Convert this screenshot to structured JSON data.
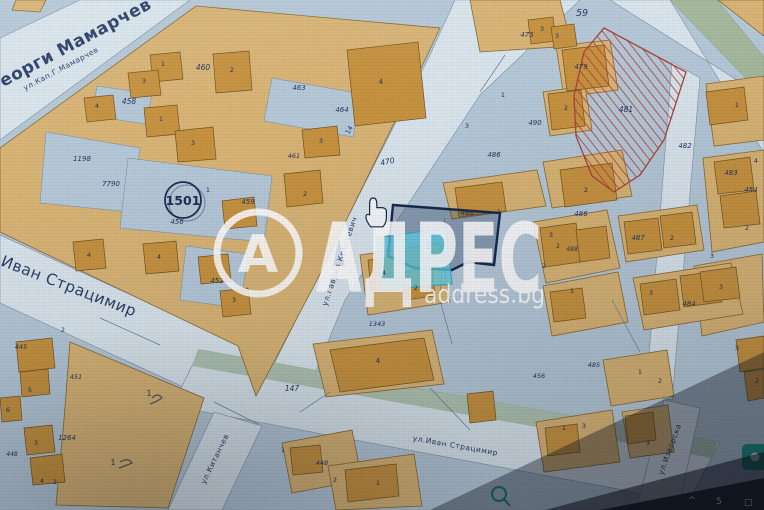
{
  "watermark": {
    "brand": "АДРЕС",
    "domain": "address.bg",
    "logo_letter": "А"
  },
  "taskbar": {
    "glyphs": [
      "^",
      "5",
      "□"
    ]
  },
  "map": {
    "type": "cadastral-map",
    "quarter_badge": "1501",
    "highlighted_parcel_number": "2",
    "street_labels": [
      {
        "name": "Георги Мамарчев",
        "x": 73,
        "y": 50,
        "s": 17,
        "r": -28,
        "w": 700,
        "ls": 1
      },
      {
        "name": "ул.Кап.Г.Мамарчев",
        "x": 62,
        "y": 71,
        "s": 7.5,
        "r": -28,
        "w": 400
      },
      {
        "name": "Иван Страцимир",
        "x": 67,
        "y": 291,
        "s": 15.5,
        "r": 21,
        "w": 500,
        "ls": 1
      },
      {
        "name": "ул.Гаврил Кръстевич",
        "x": 342,
        "y": 262,
        "s": 7.5,
        "r": -71,
        "w": 400
      },
      {
        "name": "ул.Иван Страцимир",
        "x": 455,
        "y": 448,
        "s": 7.5,
        "r": 10,
        "w": 400
      },
      {
        "name": "ул.Китанчев",
        "x": 217,
        "y": 460,
        "s": 7.5,
        "r": -64,
        "w": 400
      },
      {
        "name": "ул.Изворска",
        "x": 672,
        "y": 450,
        "s": 7.5,
        "r": -70,
        "w": 400
      }
    ],
    "parcel_labels": [
      {
        "t": "458",
        "x": 129,
        "y": 104,
        "s": 7.5,
        "it": 1
      },
      {
        "t": "460",
        "x": 203,
        "y": 70,
        "s": 7.5,
        "it": 1
      },
      {
        "t": "1",
        "x": 163,
        "y": 66,
        "s": 6.5
      },
      {
        "t": "3",
        "x": 144,
        "y": 83,
        "s": 6.5
      },
      {
        "t": "4",
        "x": 97,
        "y": 108,
        "s": 6.5
      },
      {
        "t": "2",
        "x": 232,
        "y": 72,
        "s": 6.5
      },
      {
        "t": "1",
        "x": 161,
        "y": 121,
        "s": 6.5
      },
      {
        "t": "3",
        "x": 193,
        "y": 145,
        "s": 6.5
      },
      {
        "t": "1198",
        "x": 82,
        "y": 161,
        "s": 7,
        "it": 1
      },
      {
        "t": "7790",
        "x": 111,
        "y": 186,
        "s": 7,
        "it": 1
      },
      {
        "t": "456",
        "x": 177,
        "y": 224,
        "s": 7,
        "it": 1
      },
      {
        "t": "459",
        "x": 248,
        "y": 204,
        "s": 7,
        "it": 1
      },
      {
        "t": "1",
        "x": 208,
        "y": 192,
        "s": 6.5
      },
      {
        "t": "452",
        "x": 217,
        "y": 283,
        "s": 7,
        "it": 1
      },
      {
        "t": "3",
        "x": 234,
        "y": 302,
        "s": 6.5
      },
      {
        "t": "4",
        "x": 89,
        "y": 257,
        "s": 6.5
      },
      {
        "t": "4",
        "x": 159,
        "y": 259,
        "s": 6.5
      },
      {
        "t": "2",
        "x": 305,
        "y": 196,
        "s": 6.5
      },
      {
        "t": "2",
        "x": 63,
        "y": 332,
        "s": 6.5
      },
      {
        "t": "463",
        "x": 299,
        "y": 90,
        "s": 7,
        "it": 1
      },
      {
        "t": "464",
        "x": 342,
        "y": 112,
        "s": 7,
        "it": 1
      },
      {
        "t": "4",
        "x": 381,
        "y": 84,
        "s": 7
      },
      {
        "t": "3",
        "x": 321,
        "y": 143,
        "s": 6.5
      },
      {
        "t": "461",
        "x": 294,
        "y": 158,
        "s": 6.5,
        "it": 1
      },
      {
        "t": "14",
        "x": 351,
        "y": 131,
        "s": 6.5,
        "r": -60
      },
      {
        "t": "470",
        "x": 388,
        "y": 164,
        "s": 7.5,
        "r": -12,
        "it": 1
      },
      {
        "t": "3",
        "x": 467,
        "y": 128,
        "s": 6.5
      },
      {
        "t": "1",
        "x": 503,
        "y": 97,
        "s": 6.5
      },
      {
        "t": "490",
        "x": 535,
        "y": 125,
        "s": 7,
        "it": 1
      },
      {
        "t": "486",
        "x": 494,
        "y": 157,
        "s": 7,
        "it": 1
      },
      {
        "t": "59",
        "x": 582,
        "y": 16,
        "s": 9.5,
        "it": 1
      },
      {
        "t": "475",
        "x": 527,
        "y": 37,
        "s": 7,
        "it": 1
      },
      {
        "t": "3",
        "x": 542,
        "y": 31,
        "s": 6.5
      },
      {
        "t": "3",
        "x": 557,
        "y": 38,
        "s": 6.5
      },
      {
        "t": "479",
        "x": 581,
        "y": 69,
        "s": 7,
        "it": 1
      },
      {
        "t": "2",
        "x": 566,
        "y": 110,
        "s": 6.5
      },
      {
        "t": "481",
        "x": 626,
        "y": 112,
        "s": 7.5,
        "it": 1
      },
      {
        "t": "1",
        "x": 737,
        "y": 107,
        "s": 6.5
      },
      {
        "t": "483",
        "x": 731,
        "y": 175,
        "s": 7,
        "it": 1
      },
      {
        "t": "454",
        "x": 751,
        "y": 192,
        "s": 7,
        "it": 1
      },
      {
        "t": "2",
        "x": 747,
        "y": 230,
        "s": 6.5
      },
      {
        "t": "482",
        "x": 685,
        "y": 148,
        "s": 7,
        "it": 1
      },
      {
        "t": "4",
        "x": 756,
        "y": 163,
        "s": 6.5
      },
      {
        "t": "3",
        "x": 721,
        "y": 289,
        "s": 6.5
      },
      {
        "t": "2",
        "x": 586,
        "y": 192,
        "s": 6.5
      },
      {
        "t": "486",
        "x": 581,
        "y": 216,
        "s": 7,
        "it": 1
      },
      {
        "t": "3",
        "x": 551,
        "y": 237,
        "s": 6.5
      },
      {
        "t": "2",
        "x": 558,
        "y": 248,
        "s": 6
      },
      {
        "t": "488",
        "x": 572,
        "y": 251,
        "s": 6,
        "it": 1
      },
      {
        "t": "2",
        "x": 544,
        "y": 268,
        "s": 6.5
      },
      {
        "t": "487",
        "x": 638,
        "y": 240,
        "s": 7,
        "it": 1
      },
      {
        "t": "2",
        "x": 672,
        "y": 240,
        "s": 6.5
      },
      {
        "t": "3",
        "x": 712,
        "y": 258,
        "s": 6.5
      },
      {
        "t": "1",
        "x": 572,
        "y": 293,
        "s": 6.5
      },
      {
        "t": "3",
        "x": 651,
        "y": 295,
        "s": 6.5
      },
      {
        "t": "484",
        "x": 689,
        "y": 306,
        "s": 7,
        "it": 1
      },
      {
        "t": "488",
        "x": 467,
        "y": 215,
        "s": 7,
        "it": 1
      },
      {
        "t": "1",
        "x": 499,
        "y": 214,
        "s": 6.5
      },
      {
        "t": "4",
        "x": 384,
        "y": 275,
        "s": 6.5
      },
      {
        "t": "2",
        "x": 416,
        "y": 290,
        "s": 6.5
      },
      {
        "t": "1343",
        "x": 377,
        "y": 326,
        "s": 6.5,
        "it": 1
      },
      {
        "t": "4",
        "x": 378,
        "y": 363,
        "s": 7
      },
      {
        "t": "147",
        "x": 292,
        "y": 391,
        "s": 7.5,
        "it": 1
      },
      {
        "t": "1264",
        "x": 67,
        "y": 440,
        "s": 7,
        "it": 1
      },
      {
        "t": "1",
        "x": 149,
        "y": 396,
        "s": 7.5
      },
      {
        "t": "1",
        "x": 113,
        "y": 465,
        "s": 7.5
      },
      {
        "t": "445",
        "x": 21,
        "y": 349,
        "s": 6.5,
        "it": 1
      },
      {
        "t": "5",
        "x": 30,
        "y": 392,
        "s": 6.5
      },
      {
        "t": "451",
        "x": 76,
        "y": 379,
        "s": 6.5,
        "it": 1
      },
      {
        "t": "6",
        "x": 8,
        "y": 412,
        "s": 6.5
      },
      {
        "t": "3",
        "x": 36,
        "y": 445,
        "s": 6.5
      },
      {
        "t": "448",
        "x": 12,
        "y": 456,
        "s": 6,
        "it": 1
      },
      {
        "t": "4",
        "x": 42,
        "y": 483,
        "s": 6.5
      },
      {
        "t": "2",
        "x": 55,
        "y": 484,
        "s": 6.5
      },
      {
        "t": "448",
        "x": 322,
        "y": 465,
        "s": 6.5,
        "it": 1
      },
      {
        "t": "1",
        "x": 283,
        "y": 452,
        "s": 6.5
      },
      {
        "t": "2",
        "x": 335,
        "y": 482,
        "s": 6.5
      },
      {
        "t": "1",
        "x": 378,
        "y": 485,
        "s": 6.5
      },
      {
        "t": "485",
        "x": 594,
        "y": 367,
        "s": 6.5,
        "it": 1
      },
      {
        "t": "456",
        "x": 539,
        "y": 378,
        "s": 6.5,
        "it": 1
      },
      {
        "t": "1",
        "x": 640,
        "y": 374,
        "s": 6.5
      },
      {
        "t": "2",
        "x": 660,
        "y": 383,
        "s": 6.5
      },
      {
        "t": "3",
        "x": 737,
        "y": 350,
        "s": 6.5
      },
      {
        "t": "2",
        "x": 757,
        "y": 383,
        "s": 6.5
      },
      {
        "t": "1",
        "x": 564,
        "y": 430,
        "s": 6.5
      },
      {
        "t": "3",
        "x": 584,
        "y": 428,
        "s": 6.5
      },
      {
        "t": "3",
        "x": 648,
        "y": 445,
        "s": 6.5
      }
    ]
  }
}
